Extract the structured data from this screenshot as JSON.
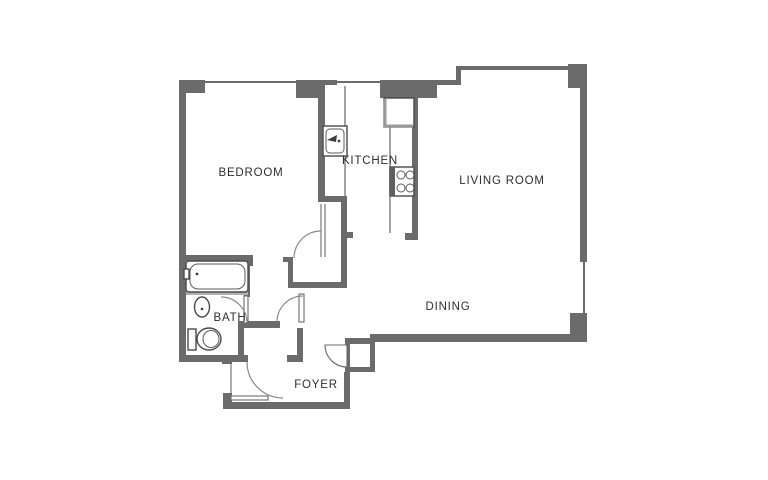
{
  "floor_plan": {
    "title": "one-bedroom apartment floor plan",
    "rooms": [
      {
        "id": "bedroom",
        "label": "BEDROOM"
      },
      {
        "id": "kitchen",
        "label": "KITCHEN"
      },
      {
        "id": "living_room",
        "label": "LIVING ROOM"
      },
      {
        "id": "dining",
        "label": "DINING"
      },
      {
        "id": "bath",
        "label": "BATH"
      },
      {
        "id": "foyer",
        "label": "FOYER"
      }
    ],
    "fixtures": [
      "bathtub-icon",
      "bath-sink-icon",
      "toilet-icon",
      "kitchen-sink-icon",
      "refrigerator-icon",
      "stove-icon"
    ],
    "colors": {
      "wall": "#6b6b6b",
      "fixture_line": "#4a4a4a",
      "label": "#2e2e2e",
      "background": "#ffffff"
    }
  }
}
